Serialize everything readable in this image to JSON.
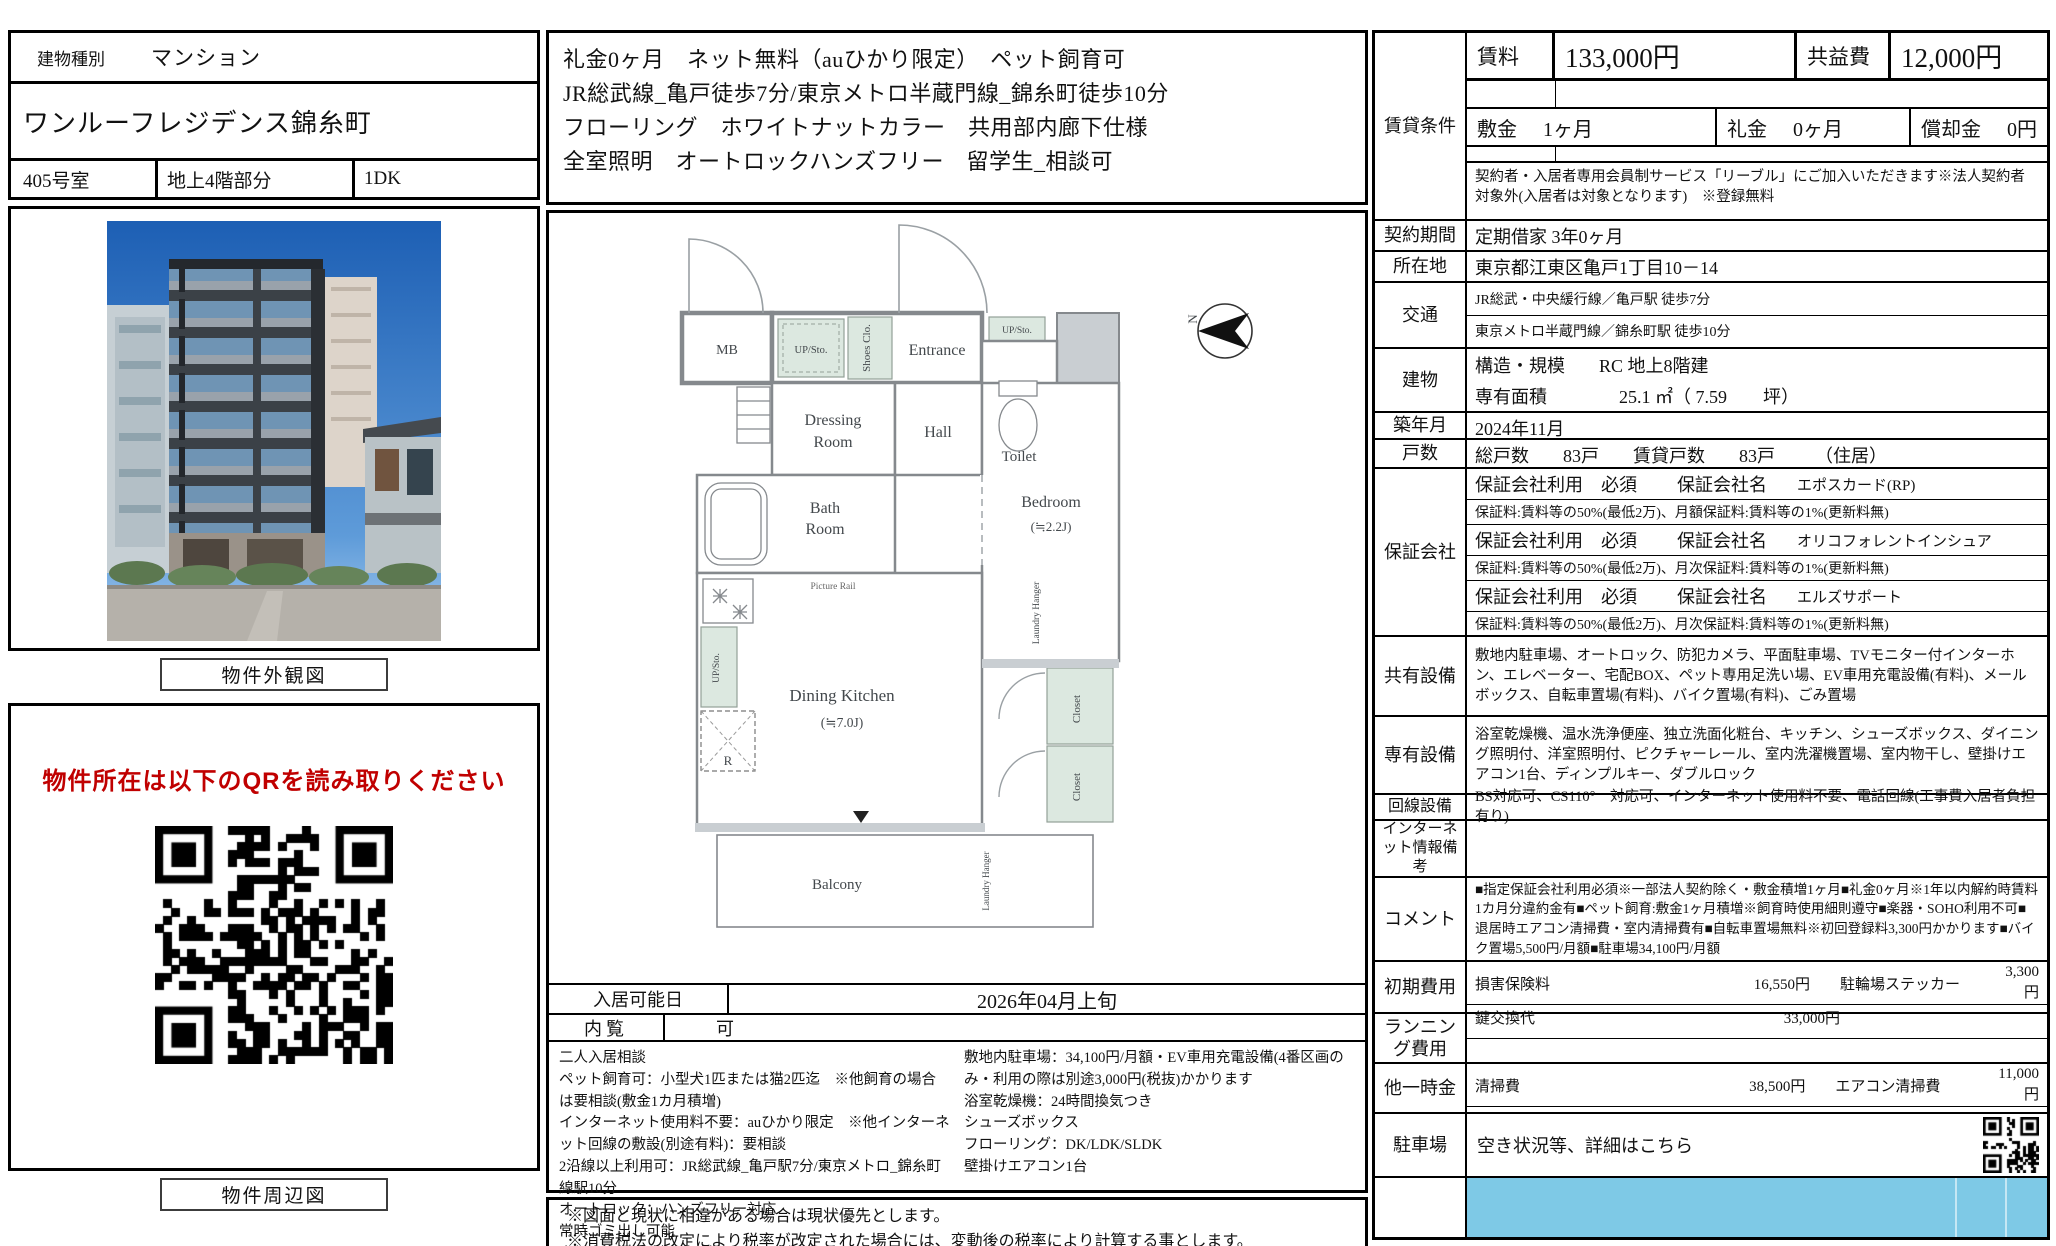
{
  "colors": {
    "red_notice": "#c00000",
    "parking_fill": "#7ec9e6"
  },
  "left": {
    "type_label": "建物種別",
    "type_value": "マンション",
    "name": "ワンルーフレジデンス錦糸町",
    "room": "405号室",
    "floor": "地上4階部分",
    "madori": "1DK",
    "photo_caption": "物件外観図",
    "qr_notice": "物件所在は以下のQRを読み取りください",
    "map_caption": "物件周辺図"
  },
  "mid": {
    "highlights": [
      "礼金0ヶ月　ネット無料（auひかり限定）　ペット飼育可",
      "JR総武線_亀戸徒歩7分/東京メトロ半蔵門線_錦糸町徒歩10分",
      "フローリング　ホワイトナットカラー　共用部内廊下仕様",
      "全室照明　オートロックハンズフリー　留学生_相談可"
    ],
    "plan": {
      "mb": "MB",
      "up_sto": "UP/Sto.",
      "shoes": "Shoes Clo.",
      "entrance": "Entrance",
      "dressing1": "Dressing",
      "dressing2": "Room",
      "hall": "Hall",
      "toilet": "Toilet",
      "bath1": "Bath",
      "bath2": "Room",
      "picture_rail": "Picture Rail",
      "bedroom": "Bedroom",
      "bedroom_size": "(≒2.2J)",
      "laundry": "Laundry Hanger",
      "dk": "Dining Kitchen",
      "dk_size": "(≒7.0J)",
      "closet": "Closet",
      "fridge": "R",
      "balcony": "Balcony",
      "north": "N"
    },
    "movein_label": "入居可能日",
    "movein_value": "2026年04月上旬",
    "viewing_label": "内覧",
    "viewing_value": "可",
    "notes_left": [
      "二人入居相談",
      "ペット飼育可：小型犬1匹または猫2匹迄　※他飼育の場合は要相談(敷金1カ月積増)",
      "インターネット使用料不要：auひかり限定　※他インターネット回線の敷設(別途有料)：要相談",
      "2沿線以上利用可：JR総武線_亀戸駅7分/東京メトロ_錦糸町線駅10分",
      "オートロック：ハンズフリー対応",
      "常時ゴミ出し可能",
      "自転車置場(無料)：無料　※初回登録料3,300円かかります",
      "バイク置場(有料)：5,500円/月額"
    ],
    "notes_right": [
      "敷地内駐車場：34,100円/月額・EV車用充電設備(4番区画のみ・利用の際は別途3,000円(税抜)かかります",
      "浴室乾燥機：24時間換気つき",
      "シューズボックス",
      "フローリング：DK/LDK/SLDK",
      "壁掛けエアコン1台"
    ],
    "disclaimers": [
      "※図面と現状に相違がある場合は現状優先とします。",
      "※消費税法の改定により税率が改定された場合には、変動後の税率により計算する事とします。"
    ]
  },
  "right": {
    "terms_label": "賃貸条件",
    "rent_label": "賃料",
    "rent": "133,000円",
    "fee_label": "共益費",
    "fee": "12,000円",
    "deposit_label": "敷金",
    "deposit": "1ヶ月",
    "reikin_label": "礼金",
    "reikin": "0ヶ月",
    "amort_label": "償却金",
    "amort": "0円",
    "member_note": "契約者・入居者専用会員制サービス「リーブル」にご加入いただきます※法人契約者対象外(入居者は対象となります)　※登録無料",
    "contract_label": "契約期間",
    "contract": "定期借家 3年0ヶ月",
    "address_label": "所在地",
    "address": "東京都江東区亀戸1丁目10－14",
    "access_label": "交通",
    "access1": "JR総武・中央緩行線／亀戸駅 徒歩7分",
    "access2": "東京メトロ半蔵門線／錦糸町駅 徒歩10分",
    "building_label": "建物",
    "structure_label": "構造・規模",
    "structure": "RC 地上8階建",
    "area_label": "専有面積",
    "area": "25.1 ㎡（ 7.59　　坪）",
    "built_label": "築年月",
    "built": "2024年11月",
    "units_label": "戸数",
    "units_total_label": "総戸数",
    "units_total": "83戸",
    "units_rent_label": "賃貸戸数",
    "units_rent": "83戸",
    "units_note": "（住居）",
    "guarantor_label": "保証会社",
    "guarantor_head": "保証会社利用　必須",
    "guarantor_name_label": "保証会社名",
    "guarantors": [
      {
        "name": "エポスカード(RP)",
        "detail": "保証料:賃料等の50%(最低2万)、月額保証料:賃料等の1%(更新料無)"
      },
      {
        "name": "オリコフォレントインシュア",
        "detail": "保証料:賃料等の50%(最低2万)、月次保証料:賃料等の1%(更新料無)"
      },
      {
        "name": "エルズサポート",
        "detail": "保証料:賃料等の50%(最低2万)、月次保証料:賃料等の1%(更新料無)"
      }
    ],
    "shared_label": "共有設備",
    "shared": "敷地内駐車場、オートロック、防犯カメラ、平面駐車場、TVモニター付インターホン、エレベーター、宅配BOX、ペット専用足洗い場、EV車用充電設備(有料)、メールボックス、自転車置場(有料)、バイク置場(有料)、ごみ置場",
    "private_label": "専有設備",
    "private": "浴室乾燥機、温水洗浄便座、独立洗面化粧台、キッチン、シューズボックス、ダイニング照明付、洋室照明付、ピクチャーレール、室内洗濯機置場、室内物干し、壁掛けエアコン1台、ディンプルキー、ダブルロック",
    "line_label": "回線設備",
    "line": "BS対応可、CS110°　対応可、インターネット使用料不要、電話回線(工事費入居者負担有り)",
    "inet_label": "インターネット情報備考",
    "comment_label": "コメント",
    "comment": "■指定保証会社利用必須※一部法人契約除く・敷金積増1ヶ月■礼金0ヶ月※1年以内解約時賃料1カ月分違約金有■ペット飼育:敷金1ヶ月積増※飼育時使用細則遵守■楽器・SOHO利用不可■退居時エアコン清掃費・室内清掃費有■自転車置場無料※初回登録料3,300円かかります■バイク置場5,500円/月額■駐車場34,100円/月額",
    "initial_label": "初期費用",
    "ins_label": "損害保険料",
    "ins": "16,550円",
    "sticker_label": "駐輪場ステッカー",
    "sticker": "3,300円",
    "keyex_label": "鍵交換代",
    "keyex": "33,000円",
    "running_label": "ランニング費用",
    "other_label": "他一時金",
    "clean_label": "清掃費",
    "clean": "38,500円",
    "ac_label": "エアコン清掃費",
    "ac": "11,000円",
    "parking_label": "駐車場",
    "parking": "空き状況等、詳細はこちら"
  }
}
